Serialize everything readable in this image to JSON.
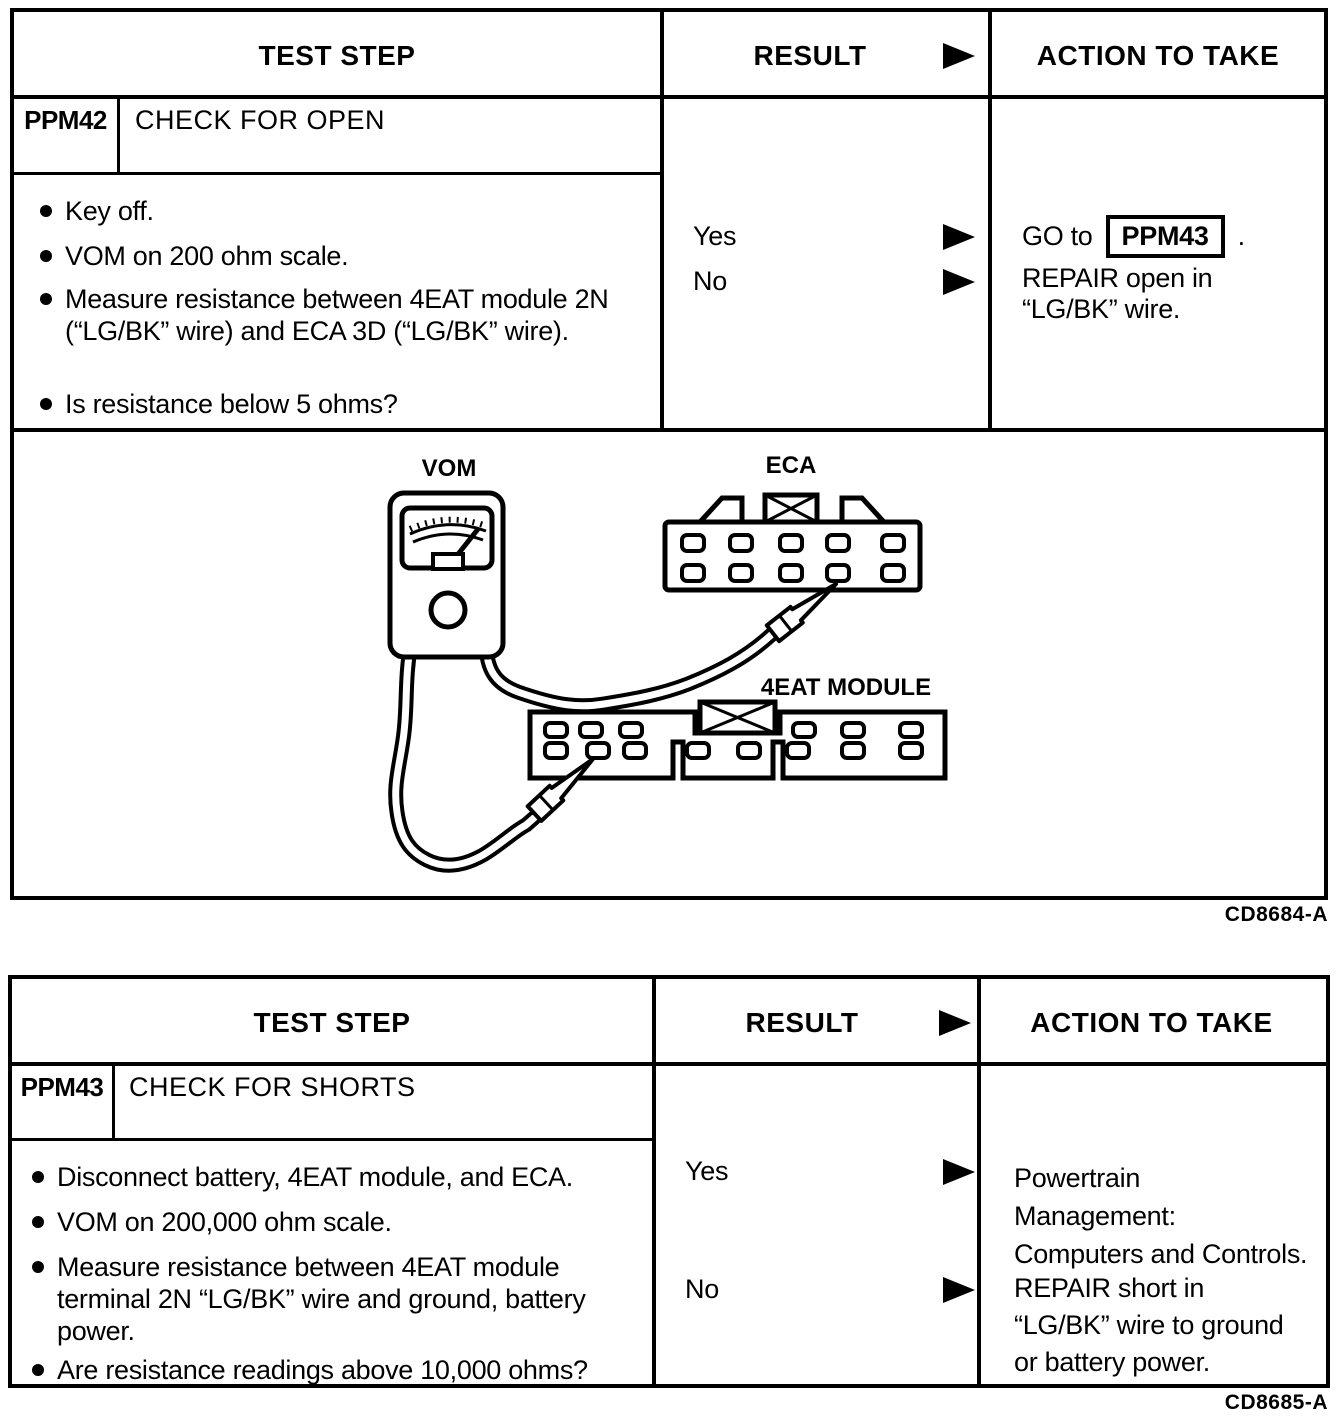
{
  "table1": {
    "header": {
      "test_step": "TEST STEP",
      "result": "RESULT",
      "action": "ACTION TO TAKE"
    },
    "step_id": "PPM42",
    "step_title": "CHECK FOR OPEN",
    "bullets": [
      "Key off.",
      "VOM on 200 ohm scale.",
      "Measure resistance between 4EAT module 2N (“LG/BK” wire) and ECA 3D (“LG/BK” wire).",
      "Is resistance below 5 ohms?"
    ],
    "yes_label": "Yes",
    "no_label": "No",
    "yes_action": {
      "prefix": "GO to",
      "target": "PPM43",
      "suffix": "."
    },
    "no_action": "REPAIR open in “LG/BK” wire.",
    "diagram": {
      "vom": "VOM",
      "eca": "ECA",
      "module": "4EAT MODULE"
    },
    "figure_code": "CD8684-A"
  },
  "table2": {
    "header": {
      "test_step": "TEST STEP",
      "result": "RESULT",
      "action": "ACTION TO TAKE"
    },
    "step_id": "PPM43",
    "step_title": "CHECK FOR SHORTS",
    "bullets": [
      "Disconnect battery, 4EAT module, and ECA.",
      "VOM on 200,000 ohm scale.",
      "Measure resistance between 4EAT module terminal 2N “LG/BK” wire and ground, battery power.",
      "Are resistance readings above 10,000 ohms?"
    ],
    "yes_label": "Yes",
    "no_label": "No",
    "yes_action_lines": [
      "Powertrain",
      "Management:",
      "Computers and Controls."
    ],
    "no_action_lines": [
      "REPAIR short in",
      "“LG/BK” wire to ground",
      "or battery power."
    ],
    "figure_code": "CD8685-A"
  },
  "colors": {
    "ink": "#000000",
    "paper": "#ffffff"
  }
}
